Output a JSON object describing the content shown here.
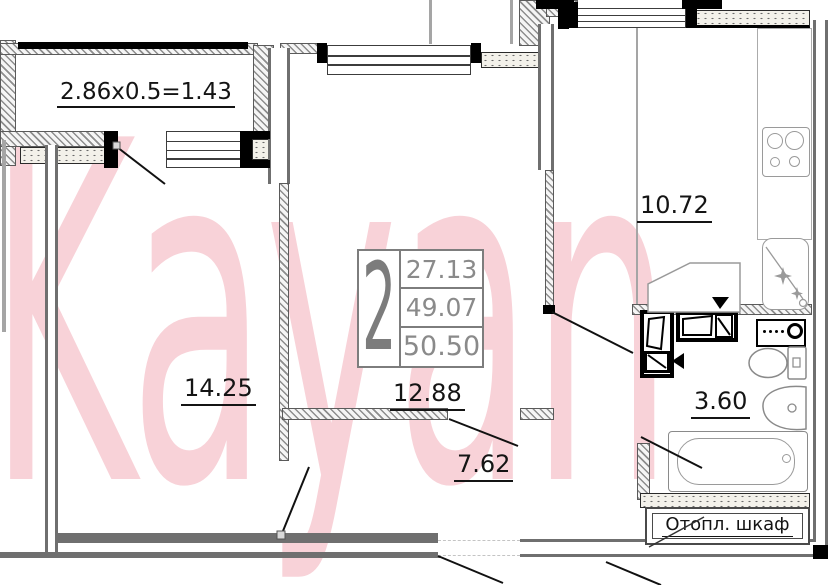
{
  "watermark": {
    "text": "Kayan",
    "color": "#f8d2d8"
  },
  "info_box": {
    "rooms": "2",
    "area_living": "27.13",
    "area_no_balcony": "49.07",
    "area_total": "50.50"
  },
  "labels": {
    "balcony_formula": "2.86x0.5=1.43",
    "living_room": "14.25",
    "bedroom": "12.88",
    "hallway": "7.62",
    "kitchen": "10.72",
    "bathroom": "3.60",
    "heating_cabinet": "Отопл. шкаф"
  },
  "colors": {
    "wall_gray": "#6f6f6f",
    "fixture_gray": "#9a9a9a",
    "watermark_pink": "#f8d2d8",
    "label_black": "#141414",
    "info_gray": "#8a8a8a",
    "black": "#000000"
  }
}
